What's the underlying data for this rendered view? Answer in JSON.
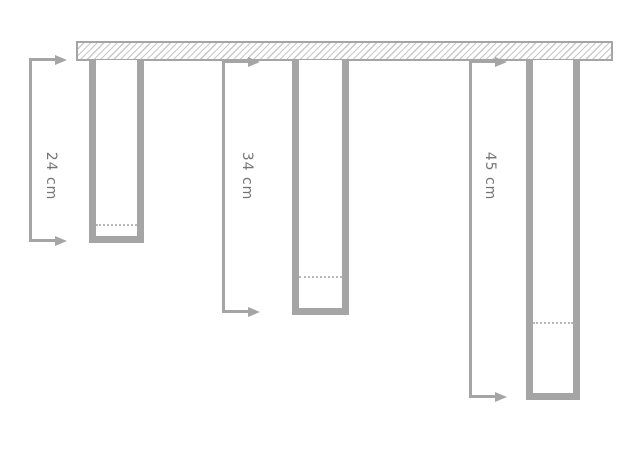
{
  "diagram": {
    "measurements": [
      {
        "label": "24 cm",
        "value": 24,
        "unit": "cm"
      },
      {
        "label": "34 cm",
        "value": 34,
        "unit": "cm"
      },
      {
        "label": "45 cm",
        "value": 45,
        "unit": "cm"
      }
    ],
    "colors": {
      "line": "#a5a5a5",
      "label_text": "#757575",
      "hatch_line": "#c8c8c8",
      "level_line": "#b8b8b8",
      "background": "#ffffff"
    }
  }
}
